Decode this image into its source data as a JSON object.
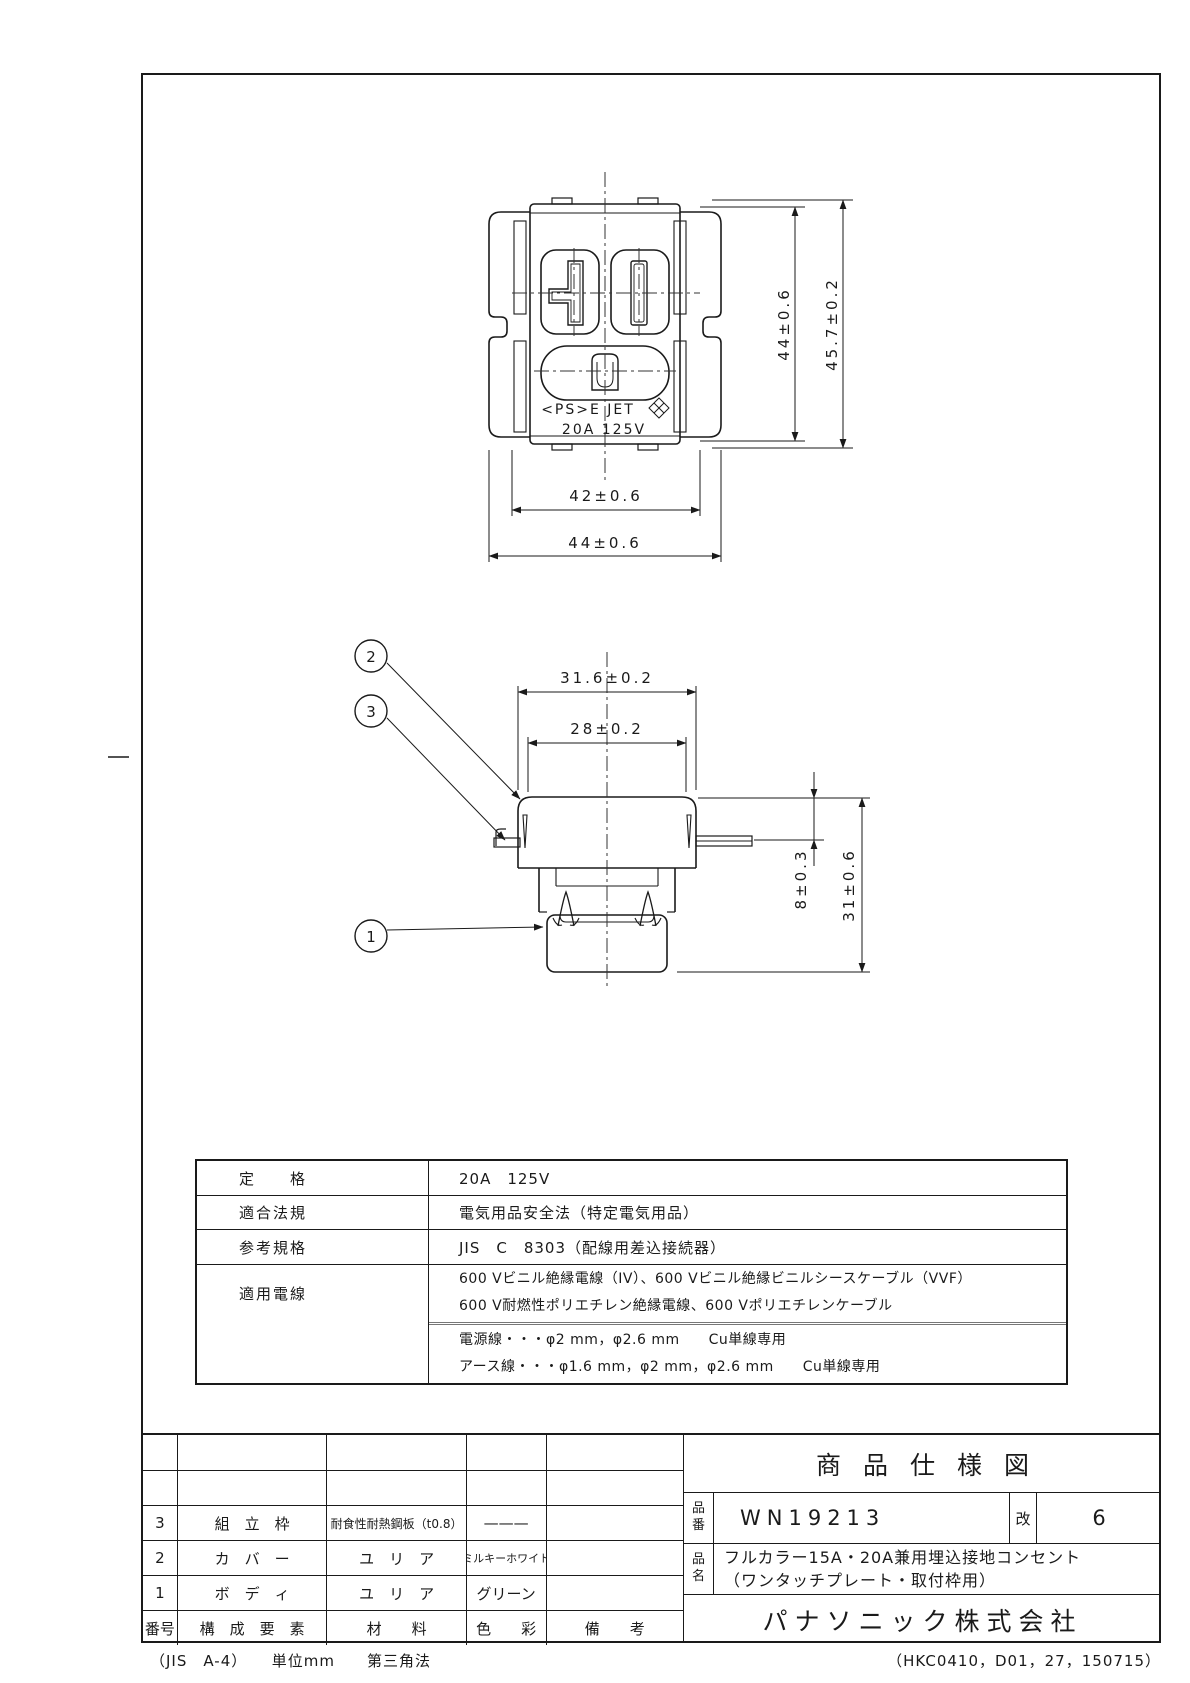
{
  "drawing": {
    "front_view": {
      "marking_line1": "<PS>E JET",
      "marking_line2": "20A 125V",
      "dim_body_height": "44±0.6",
      "dim_frame_height": "45.7±0.2",
      "dim_body_width": "42±0.6",
      "dim_frame_width": "44±0.6"
    },
    "side_view": {
      "dim_cover_width_outer": "31.6±0.2",
      "dim_cover_width_inner": "28±0.2",
      "dim_cover_height": "8±0.3",
      "dim_total_depth": "31±0.6",
      "callout_1": "1",
      "callout_2": "2",
      "callout_3": "3"
    }
  },
  "spec_table": {
    "rows": [
      {
        "label": "定　　格",
        "value": "20A　125V"
      },
      {
        "label": "適合法規",
        "value": "電気用品安全法（特定電気用品）"
      },
      {
        "label": "参考規格",
        "value": "JIS　C　8303（配線用差込接続器）"
      },
      {
        "label": "適用電線",
        "cables_line1": "600 Vビニル絶縁電線（IV）、600 Vビニル絶縁ビニルシースケーブル（VVF）",
        "cables_line2": "600 V耐燃性ポリエチレン絶縁電線、600 Vポリエチレンケーブル",
        "wires_line1": "電源線・・・φ2 mm，φ2.6 mm　　Cu単線専用",
        "wires_line2": "アース線・・・φ1.6 mm，φ2 mm，φ2.6 mm　　Cu単線専用"
      }
    ]
  },
  "parts_table": {
    "header": {
      "no": "番号",
      "component": "構　成　要　素",
      "material": "材　　料",
      "color": "色　　彩",
      "note": "備　　考"
    },
    "rows": [
      {
        "no": "3",
        "component": "組　立　枠",
        "material": "耐食性耐熱鋼板（t0.8）",
        "color": "———",
        "note": ""
      },
      {
        "no": "2",
        "component": "カ　バ　ー",
        "material": "ユ　リ　ア",
        "color": "ミルキーホワイト",
        "note": ""
      },
      {
        "no": "1",
        "component": "ボ　デ　ィ",
        "material": "ユ　リ　ア",
        "color": "グリーン",
        "note": ""
      }
    ]
  },
  "title_block": {
    "title": "商品仕様図",
    "part_no_label": "品番",
    "part_no": "WN19213",
    "revision_label": "改",
    "revision": "6",
    "product_name_label": "品名",
    "product_name_line1": "フルカラー15A・20A兼用埋込接地コンセント",
    "product_name_line2": "（ワンタッチプレート・取付枠用）",
    "company": "パナソニック株式会社"
  },
  "footer": {
    "left": "（JIS　A-4）　　単位mm　　第三角法",
    "right": "（HKC0410，D01，27，150715）"
  }
}
